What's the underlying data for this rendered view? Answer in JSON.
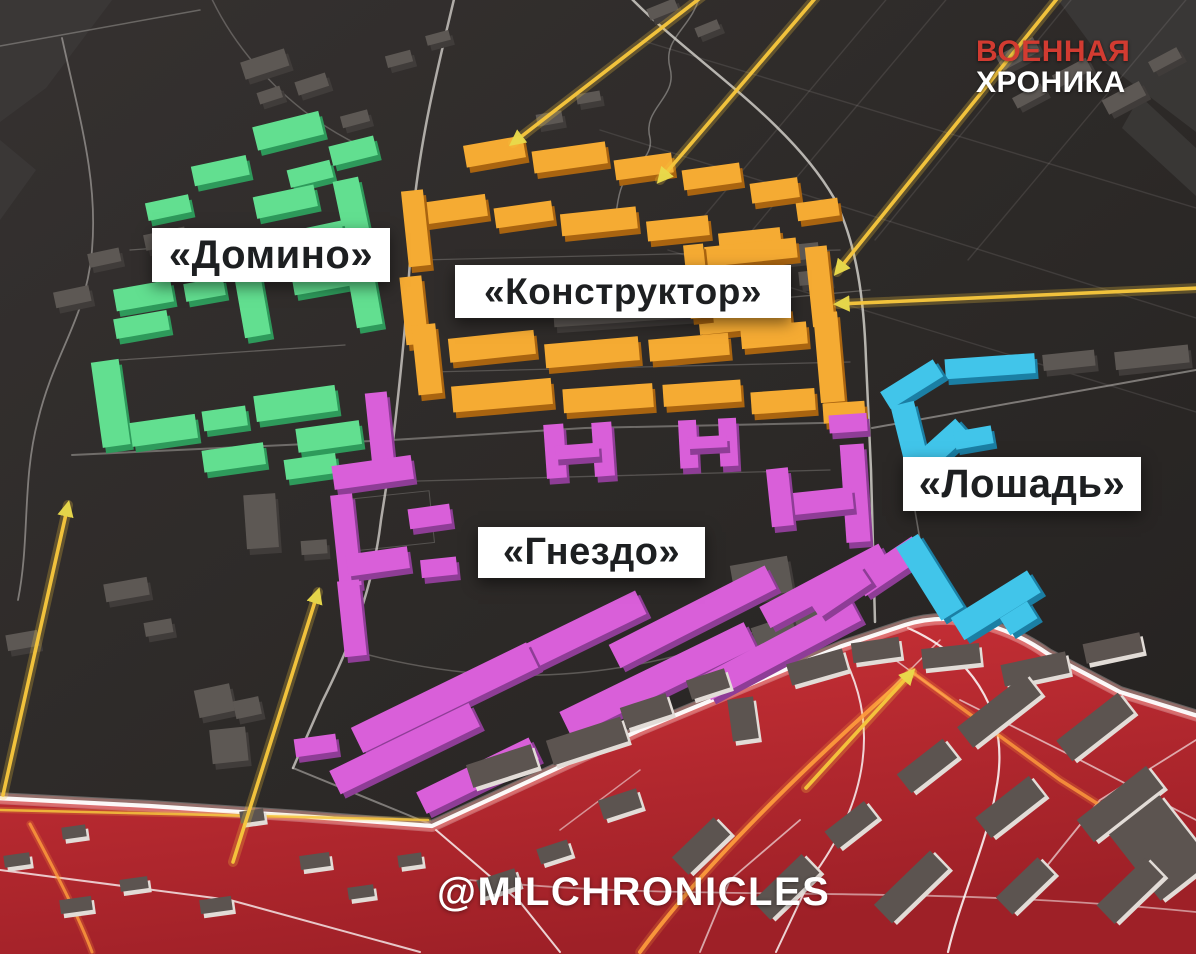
{
  "branding": {
    "logo": {
      "line1": "ВОЕННАЯ",
      "line2": "ХРОНИКА",
      "line1_color": "#d23b31",
      "line2_color": "#ffffff"
    },
    "watermark": "@MILCHRONICLES"
  },
  "zones": [
    {
      "id": "domino",
      "label": "«Домино»",
      "color": "#62df90",
      "side_color": "#2e9a5b"
    },
    {
      "id": "konstruktor",
      "label": "«Конструктор»",
      "color": "#f5ab33",
      "side_color": "#a96410"
    },
    {
      "id": "gnezdo",
      "label": "«Гнездо»",
      "color": "#d95fd9",
      "side_color": "#8e3d96"
    },
    {
      "id": "loshad",
      "label": "«Лошадь»",
      "color": "#41c5ea",
      "side_color": "#1b7fa4"
    }
  ],
  "map": {
    "background_color": "#2c2927",
    "captured_zone_color": "#c1282f",
    "frontline_color": "#ffffff",
    "attack_arrow_color": "#f6c63d",
    "arrowhead_color": "#e9da4b",
    "road_color": "#cfccc7",
    "red_zone_road_color": "#ffffff",
    "red_zone_orange_road_color": "#ff9e3d",
    "label_text_color": "#1d1f21",
    "label_background": "#ffffff"
  }
}
